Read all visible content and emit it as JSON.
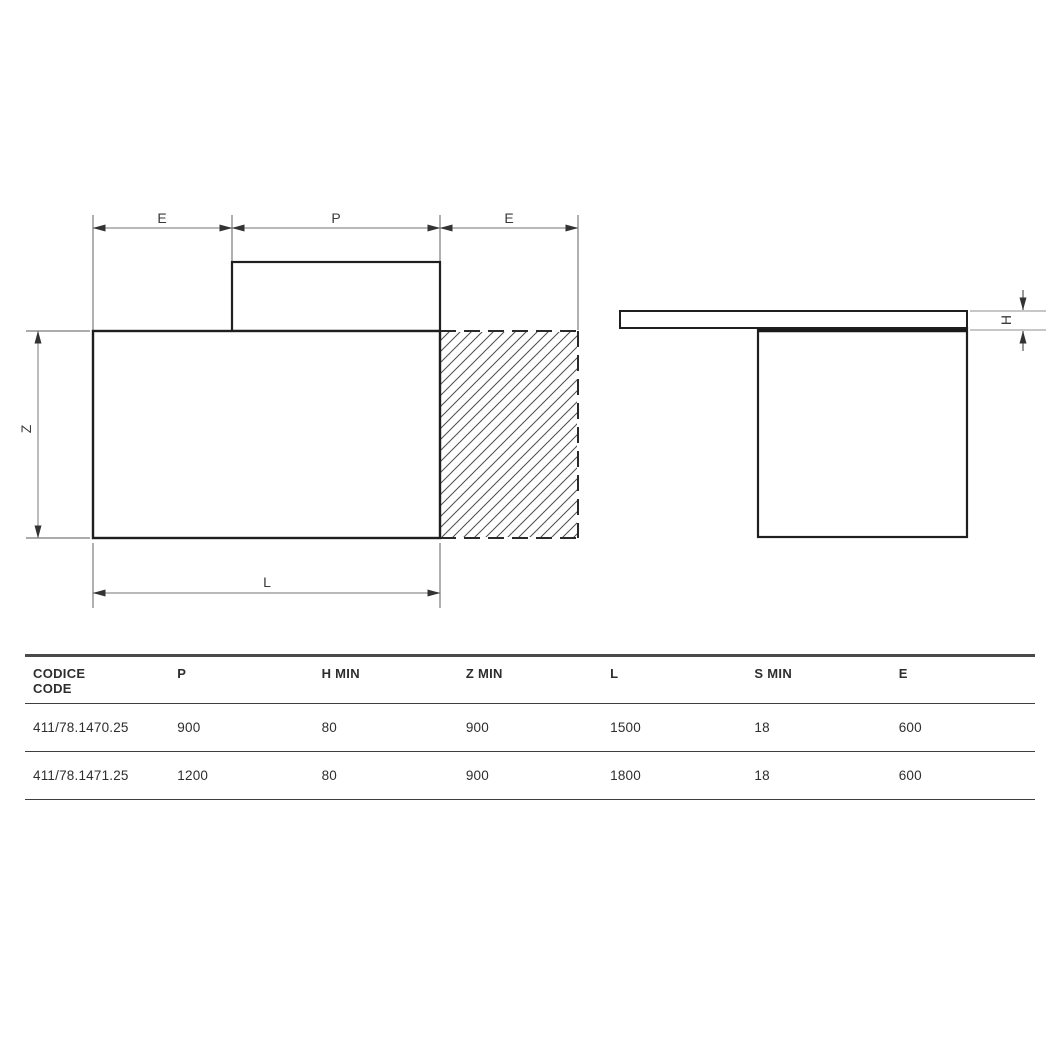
{
  "page": {
    "background": "#ffffff"
  },
  "colors": {
    "shape_line": "#1f1f1f",
    "dimension_line": "#8f8f8f",
    "extension_line": "#7a7a7a",
    "arrowhead": "#333333",
    "hatch_line": "#4d4d4d",
    "label_text": "#3a3a3a",
    "table_top_border": "#4a4a4a",
    "table_rule": "#3f3f3f",
    "table_text": "#2e2e2e"
  },
  "diagram": {
    "plan_view": {
      "labels": {
        "e_left": "E",
        "p": "P",
        "e_right": "E",
        "z": "Z",
        "l": "L"
      }
    },
    "side_view": {
      "labels": {
        "h": "H"
      }
    }
  },
  "table": {
    "columns": [
      "CODICE\nCODE",
      "P",
      "H MIN",
      "Z MIN",
      "L",
      "S MIN",
      "E"
    ],
    "rows": [
      {
        "cells": [
          "411/78.1470.25",
          "900",
          "80",
          "900",
          "1500",
          "18",
          "600"
        ]
      },
      {
        "cells": [
          "411/78.1471.25",
          "1200",
          "80",
          "900",
          "1800",
          "18",
          "600"
        ]
      }
    ]
  }
}
